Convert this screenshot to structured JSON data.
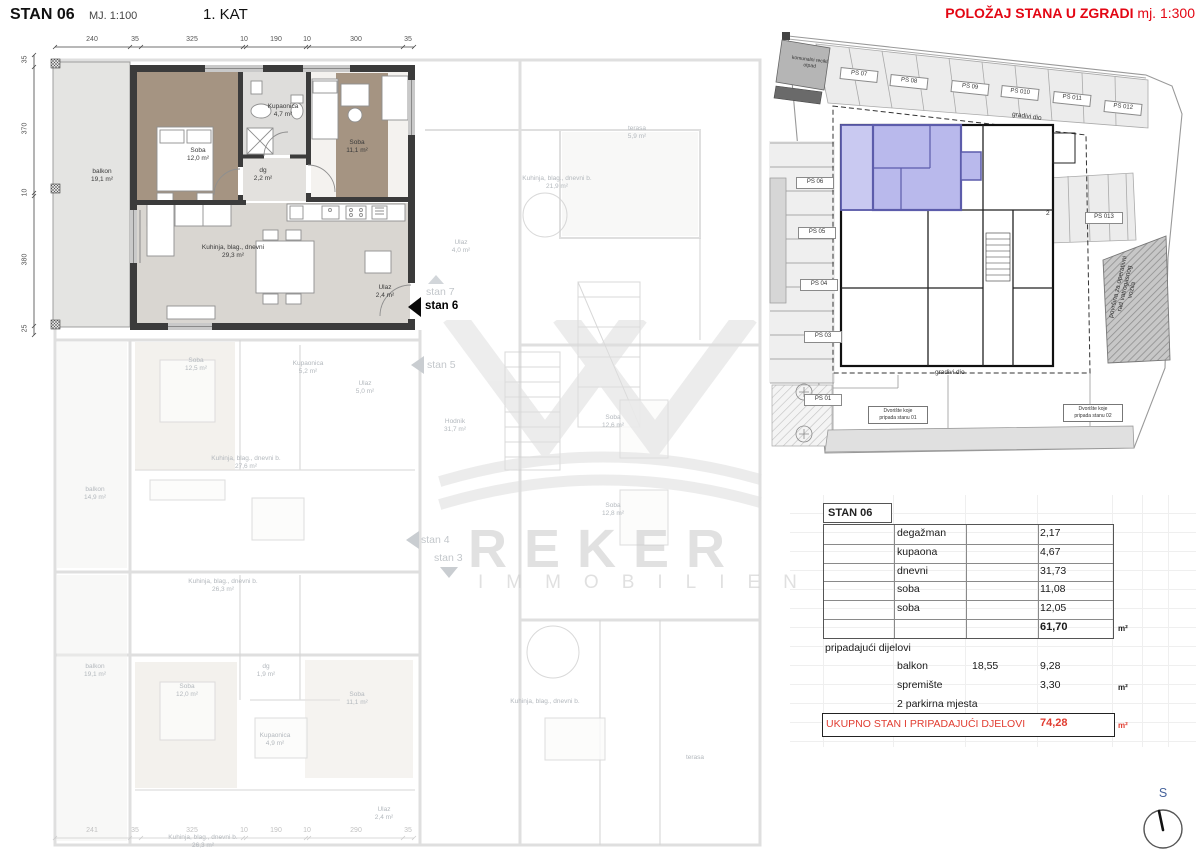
{
  "header": {
    "title": "STAN 06",
    "scale": "MJ. 1:100",
    "floor": "1. KAT"
  },
  "site_header": {
    "title": "POLOŽAJ STANA U ZGRADI",
    "scale": "mj. 1:300"
  },
  "colors": {
    "accent_red": "#e30613",
    "table_red": "#e13c30",
    "highlight_fill": "#b9b9ec",
    "highlight_wall": "#5c5cab"
  },
  "plan": {
    "dims_top": [
      "240",
      "35",
      "325",
      "10",
      "190",
      "10",
      "300",
      "35"
    ],
    "dims_left": [
      "35",
      "370",
      "10",
      "380",
      "25"
    ],
    "dims_bottom": [
      "241",
      "35",
      "325",
      "10",
      "190",
      "10",
      "290",
      "35"
    ],
    "rooms": {
      "balkon": "balkon\n19,1 m²",
      "soba1": "Soba\n12,0 m²",
      "kupaonica": "Kupaonica\n4,7 m²",
      "soba2": "Soba\n11,1 m²",
      "dg": "dg\n2,2 m²",
      "kuhinja": "Kuhinja, blag., dnevni\n29,3 m²",
      "ulaz": "Ulaz\n2,4 m²"
    },
    "stan_current": "stan 6",
    "stan_7": "stan 7",
    "stan_5": "stan 5",
    "stan_4": "stan 4",
    "stan_3": "stan 3",
    "faded": [
      "Hodnik\n31,7 m²",
      "Soba\n12,6 m²",
      "Soba\n12,8 m²",
      "terasa\n5,9 m²",
      "Kuhinja, blag., dnevni b.\n21,9 m²",
      "Ulaz\n4,0 m²",
      "Soba\n12,5 m²",
      "Kupaonica\n5,2 m²",
      "Ulaz\n5,0 m²",
      "Kuhinja, blag., dnevni b.\n27,6 m²",
      "balkon\n14,9 m²",
      "Kuhinja, blag., dnevni b.\n26,3 m²",
      "balkon\n19,1 m²",
      "Soba\n12,0 m²",
      "dg\n1,9 m²",
      "Soba\n11,1 m²",
      "Kupaonica\n4,9 m²",
      "Ulaz\n2,4 m²",
      "Kuhinja, blag., dnevni b.\n26,3 m²",
      "Kuhinja, blag., dnevni b.",
      "terasa"
    ]
  },
  "site": {
    "parking_top": [
      "PS 07",
      "PS 08",
      "PS 09",
      "PS 010",
      "PS 011",
      "PS 012"
    ],
    "parking_left": [
      "PS 06",
      "PS 05",
      "PS 04",
      "PS 03",
      "PS 01"
    ],
    "ps013": "PS 013",
    "ps02_part": "2",
    "waste_label": "komunalni recikl.\notpad",
    "boundary_top": "gradivi dio",
    "boundary_bottom": "gradivi dio",
    "fire_label": "površina za operativni\nrad vatrogasnog\nvozila",
    "yard1": "Dvorište koje\npripada stanu 01",
    "yard2": "Dvorište koje\npripada stanu 02"
  },
  "table": {
    "header": "STAN 06",
    "rows": [
      {
        "label": "degažman",
        "value": "2,17"
      },
      {
        "label": "kupaona",
        "value": "4,67"
      },
      {
        "label": "dnevni",
        "value": "31,73"
      },
      {
        "label": "soba",
        "value": "11,08"
      },
      {
        "label": "soba",
        "value": "12,05"
      }
    ],
    "total": "61,70",
    "unit": "m²",
    "section2": "pripadajući dijelovi",
    "balkon_label": "balkon",
    "balkon_raw": "18,55",
    "balkon_value": "9,28",
    "spremiste_label": "spremište",
    "spremiste_value": "3,30",
    "parking_note": "2 parkirna mjesta",
    "total_label": "UKUPNO STAN I PRIPADAJUĆI DJELOVI",
    "total_value": "74,28"
  },
  "watermark": {
    "line1": "REKER",
    "line2": "IMMOBILIEN"
  },
  "compass": {
    "label": "S"
  }
}
